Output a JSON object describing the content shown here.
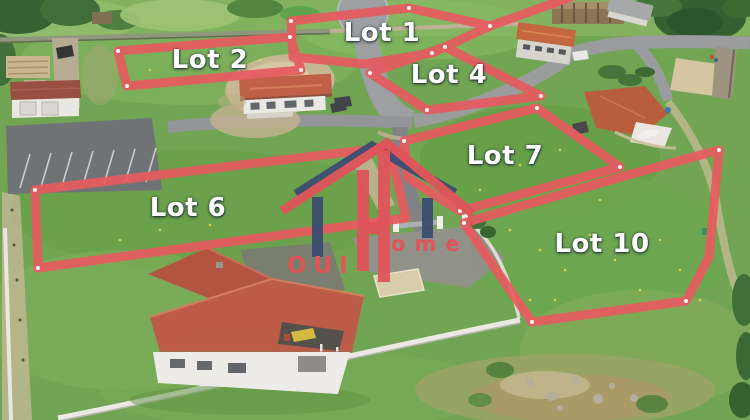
{
  "annotations": {
    "outline_color": "#e65b60",
    "label_color": "#ffffff",
    "lots": [
      {
        "id": "lot-1",
        "label": "Lot 1"
      },
      {
        "id": "lot-2",
        "label": "Lot 2"
      },
      {
        "id": "lot-4",
        "label": "Lot 4"
      },
      {
        "id": "lot-6",
        "label": "Lot 6"
      },
      {
        "id": "lot-7",
        "label": "Lot 7"
      },
      {
        "id": "lot-10",
        "label": "Lot 10"
      }
    ]
  },
  "watermark": {
    "text_left": "OUI",
    "text_right": "ome",
    "red": "#e0545a",
    "blue": "#3c4d72"
  }
}
